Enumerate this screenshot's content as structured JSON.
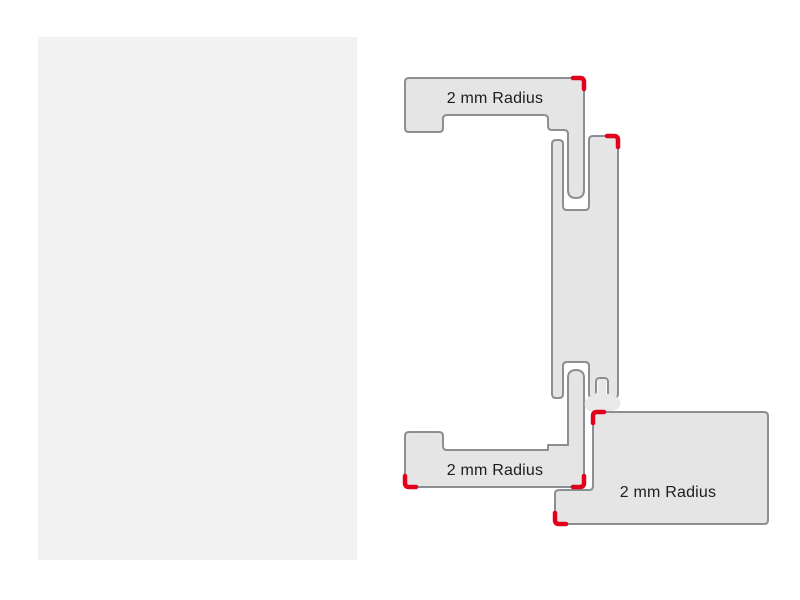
{
  "labels": {
    "top_frame_radius": "2 mm Radius",
    "bottom_frame_radius": "2 mm Radius",
    "door_leaf_radius": "2 mm Radius"
  },
  "colors": {
    "background": "#ffffff",
    "panel_fill": "#f2f2f3",
    "profile_fill": "#e5e5e6",
    "profile_outline": "#8b8f92",
    "seal_fill": "#e9e9ea",
    "radius_marker": "#e2001a",
    "label_text": "#1d1d1b"
  },
  "diagram": {
    "type": "door-frame-profile-cross-section",
    "radius_marker_count": 6
  }
}
